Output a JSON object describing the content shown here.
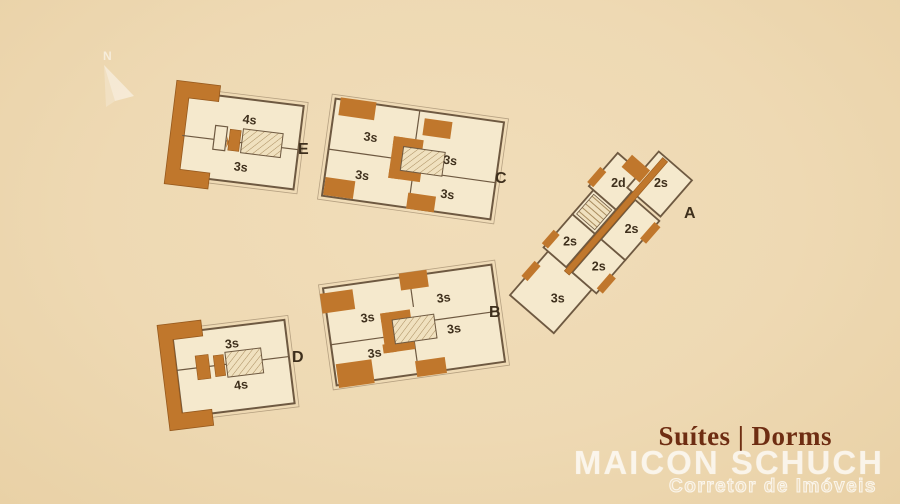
{
  "compass": {
    "north_label": "N"
  },
  "buildings": [
    {
      "label": "E",
      "units": [
        "4s",
        "3s"
      ]
    },
    {
      "label": "C",
      "units": [
        "3s",
        "3s",
        "3s",
        "3s"
      ]
    },
    {
      "label": "A",
      "units": [
        "2d",
        "2s",
        "2s",
        "2s",
        "2s",
        "3s"
      ]
    },
    {
      "label": "D",
      "units": [
        "3s",
        "4s"
      ]
    },
    {
      "label": "B",
      "units": [
        "3s",
        "3s",
        "3s",
        "3s"
      ]
    }
  ],
  "legend": {
    "title": "Suítes | Dorms"
  },
  "branding": {
    "name": "MAICON SCHUCH",
    "subtitle": "Corretor de Imóveis"
  },
  "colors": {
    "background": "#eed9b3",
    "floor": "#f5e9cd",
    "accent": "#c0772c",
    "wall": "#6e5941",
    "unit_text": "#3e2f1c",
    "title_text": "#6e2d12",
    "watermark": "#ffffff"
  }
}
